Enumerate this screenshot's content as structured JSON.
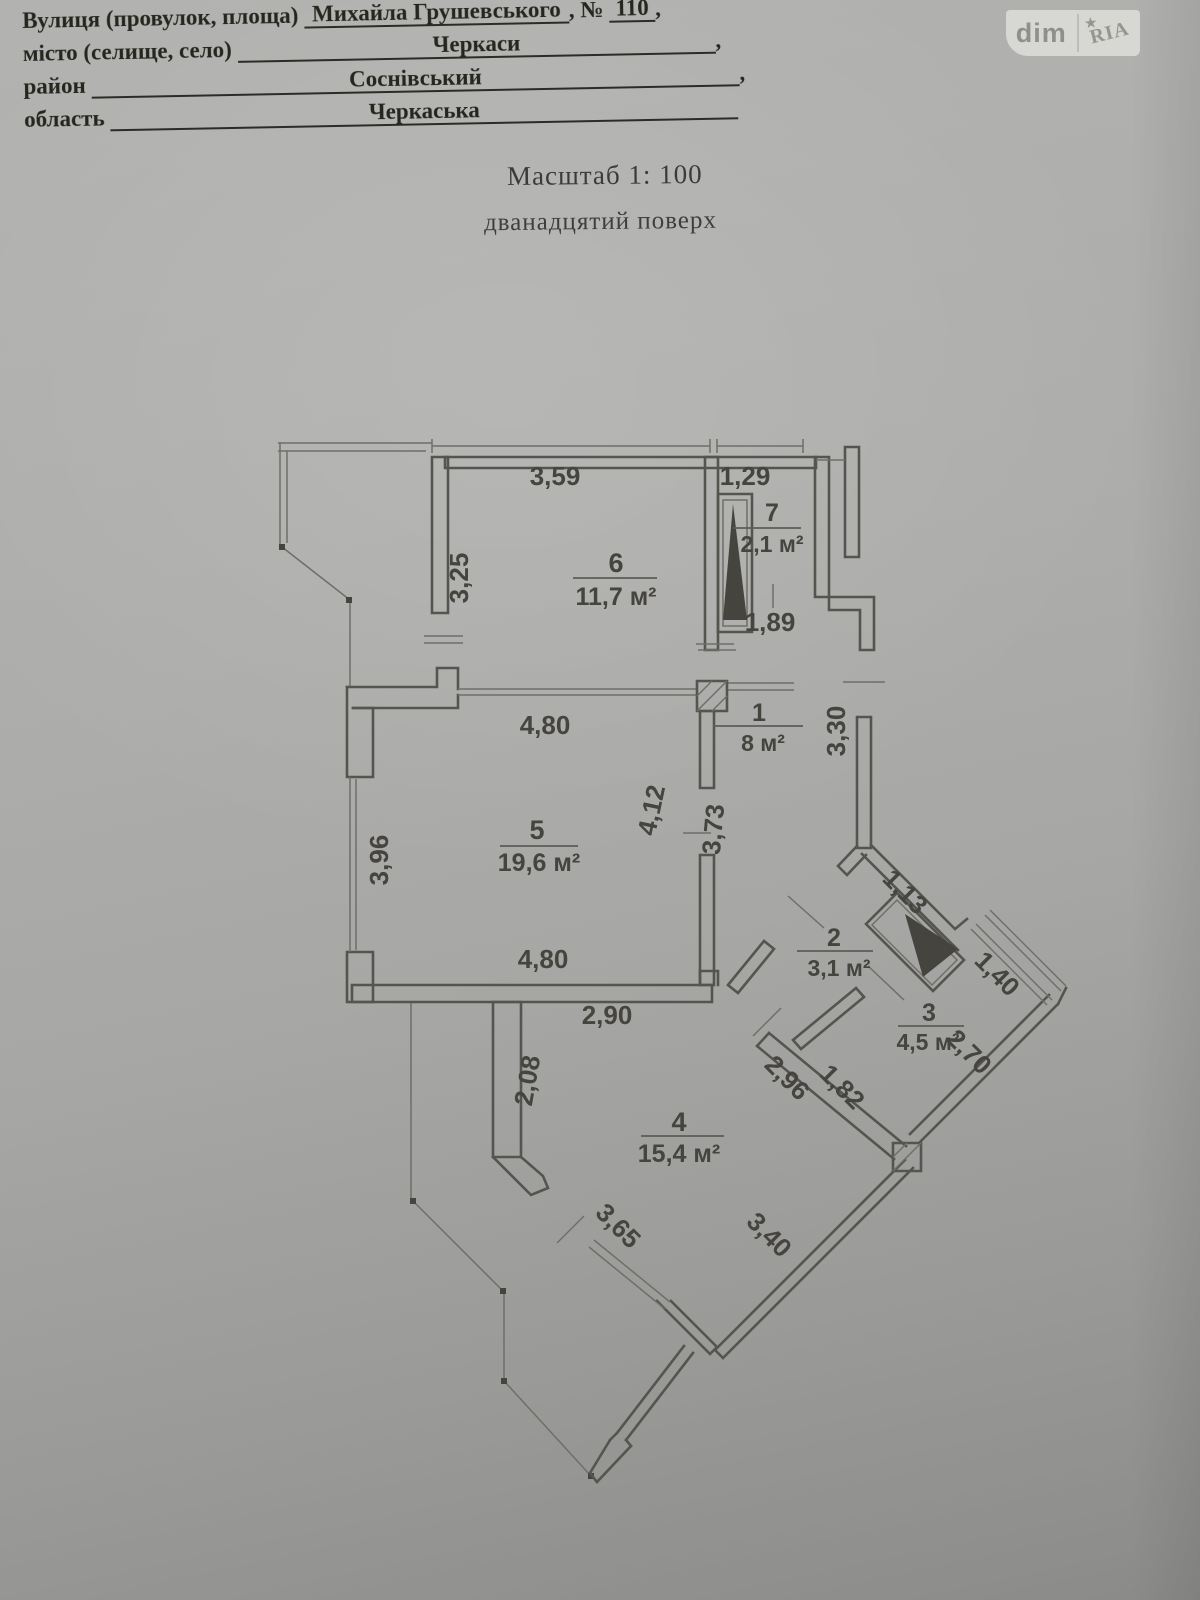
{
  "header": {
    "line1_label": "Вулиця (провулок, площа)",
    "line1_value": "Михайла Грушевського",
    "line1_no_label": ", №",
    "line1_no_value": "110",
    "comma": ",",
    "line2_label": "місто (селище, село)",
    "line2_value": "Черкаси",
    "line3_label": "район",
    "line3_value": "Соснівський",
    "line4_label": "область",
    "line4_value": "Черкаська"
  },
  "logo": {
    "dim": "dim",
    "ria": "RIA",
    "star_icon": "★"
  },
  "captions": {
    "scale": "Масштаб 1: 100",
    "floor": "дванадцятий поверх"
  },
  "plan": {
    "rooms": {
      "r1_num": "1",
      "r1_area": "8 м²",
      "r2_num": "2",
      "r2_area": "3,1 м²",
      "r3_num": "3",
      "r3_area": "4,5 м²",
      "r4_num": "4",
      "r4_area": "15,4 м²",
      "r5_num": "5",
      "r5_area": "19,6 м²",
      "r6_num": "6",
      "r6_area": "11,7 м²",
      "r7_num": "7",
      "r7_area": "2,1 м²"
    },
    "dims": {
      "d359": "3,59",
      "d129": "1,29",
      "d325": "3,25",
      "d189": "1,89",
      "d480a": "4,80",
      "d480b": "4,80",
      "d396": "3,96",
      "d412": "4,12",
      "d373": "3,73",
      "d330": "3,30",
      "d113": "1,13",
      "d140": "1,40",
      "d270": "2,70",
      "d290": "2,90",
      "d208": "2,08",
      "d296": "2,96",
      "d182": "1,82",
      "d365": "3,65",
      "d340": "3,40"
    }
  }
}
